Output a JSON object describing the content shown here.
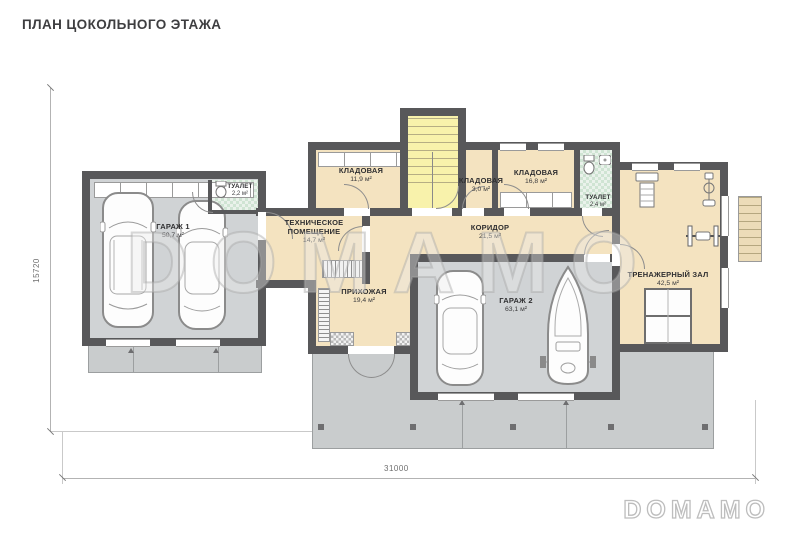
{
  "title": "ПЛАН ЦОКОЛЬНОГО ЭТАЖА",
  "watermark": {
    "text": "DOMAMO"
  },
  "brand_logo": {
    "text": "DOMAMO"
  },
  "dimensions": {
    "bottom": "31000",
    "left": "15720"
  },
  "rooms": [
    {
      "id": "garage-1",
      "name": "ГАРАЖ 1",
      "area": "50,7 м²"
    },
    {
      "id": "wc-1",
      "name": "ТУАЛЕТ",
      "area": "2,2 м²"
    },
    {
      "id": "tech-room",
      "name": "ТЕХНИЧЕСКОЕ ПОМЕЩЕНИЕ",
      "area": "14,7 м²"
    },
    {
      "id": "storage-1",
      "name": "КЛАДОВАЯ",
      "area": "11,9 м²"
    },
    {
      "id": "storage-2",
      "name": "КЛАДОВАЯ",
      "area": "3,0 м²"
    },
    {
      "id": "storage-3",
      "name": "КЛАДОВАЯ",
      "area": "16,8 м²"
    },
    {
      "id": "wc-2",
      "name": "ТУАЛЕТ",
      "area": "2,4 м²"
    },
    {
      "id": "corridor",
      "name": "КОРИДОР",
      "area": "21,5 м²"
    },
    {
      "id": "hallway",
      "name": "ПРИХОЖАЯ",
      "area": "19,4 м²"
    },
    {
      "id": "garage-2",
      "name": "ГАРАЖ 2",
      "area": "63,1 м²"
    },
    {
      "id": "gym",
      "name": "ТРЕНАЖЕРНЫЙ ЗАЛ",
      "area": "42,5 м²"
    }
  ],
  "icons": [
    "suv-top-view-icon",
    "car-top-view-icon",
    "sedan-top-view-icon",
    "boat-on-trailer-icon",
    "treadmill-icon",
    "exercise-bike-icon",
    "bench-press-icon",
    "table-tennis-table-icon",
    "toilet-icon",
    "sink-icon",
    "stairs-icon"
  ],
  "colors": {
    "wall": "#58585a",
    "wood_floor": "#f4e3c0",
    "stairs_floor": "#f8f2ab",
    "wc_floor": "#d9e9dc",
    "garage_floor": "#d0d3d5",
    "apron": "#c9cccd",
    "dimension": "#8a8a8a",
    "watermark": "#d6d6d6"
  }
}
